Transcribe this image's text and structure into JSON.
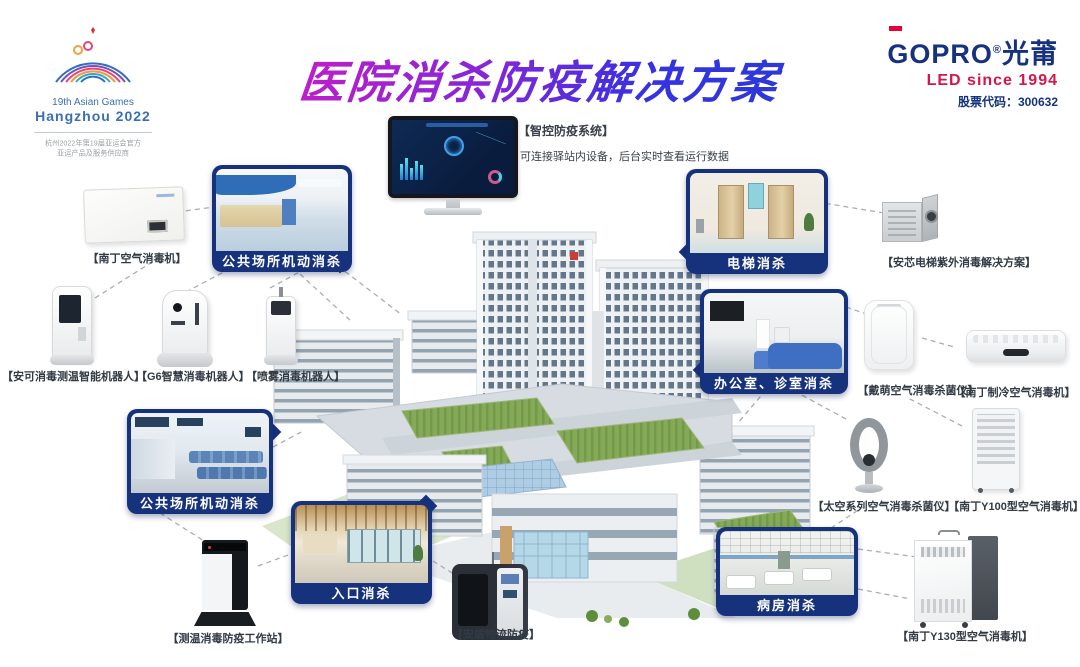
{
  "header": {
    "title": "医院消杀防疫解决方案",
    "asian_games": {
      "line1": "19th Asian Games",
      "line2": "Hangzhou 2022",
      "note1": "杭州2022年第19届亚运会官方",
      "note2": "亚运产品及服务供应商"
    },
    "brand": {
      "logo_en": "GOPRO",
      "reg": "®",
      "logo_cn": "光莆",
      "tagline": "LED since 1994",
      "stock": "股票代码：300632"
    }
  },
  "system": {
    "name": "【智控防疫系统】",
    "desc": "可连接驿站内设备，后台实时查看运行数据"
  },
  "callouts": {
    "public_top": "公共场所机动消杀",
    "public_left": "公共场所机动消杀",
    "entrance": "入口消杀",
    "elevator": "电梯消杀",
    "office": "办公室、诊室消杀",
    "ward": "病房消杀"
  },
  "products": {
    "nanding_wall": "【南丁空气消毒机】",
    "anke_robot": "【安可消毒测温智能机器人】",
    "g6_robot": "【G6智慧消毒机器人】",
    "spray_robot": "【喷雾消毒机器人】",
    "anxin_elevator": "【安芯电梯紫外消毒解决方案】",
    "daimeng_purifier": "【戴萌空气消毒杀菌仪】",
    "nanding_cooler": "【南丁制冷空气消毒机】",
    "space_series": "【太空系列空气消毒杀菌仪】",
    "y100": "【南丁Y100型空气消毒机】",
    "y130": "【南丁Y130型空气消毒机】",
    "temp_station": "【测温消毒防疫工作站】",
    "andun_logistics": "【安盾物流防疫】"
  },
  "colors": {
    "callout_blue": "#17327d",
    "title_gradient_start": "#c81dc6",
    "title_gradient_end": "#2b3bd4",
    "brand_navy": "#16327f",
    "brand_red": "#d5164a"
  }
}
